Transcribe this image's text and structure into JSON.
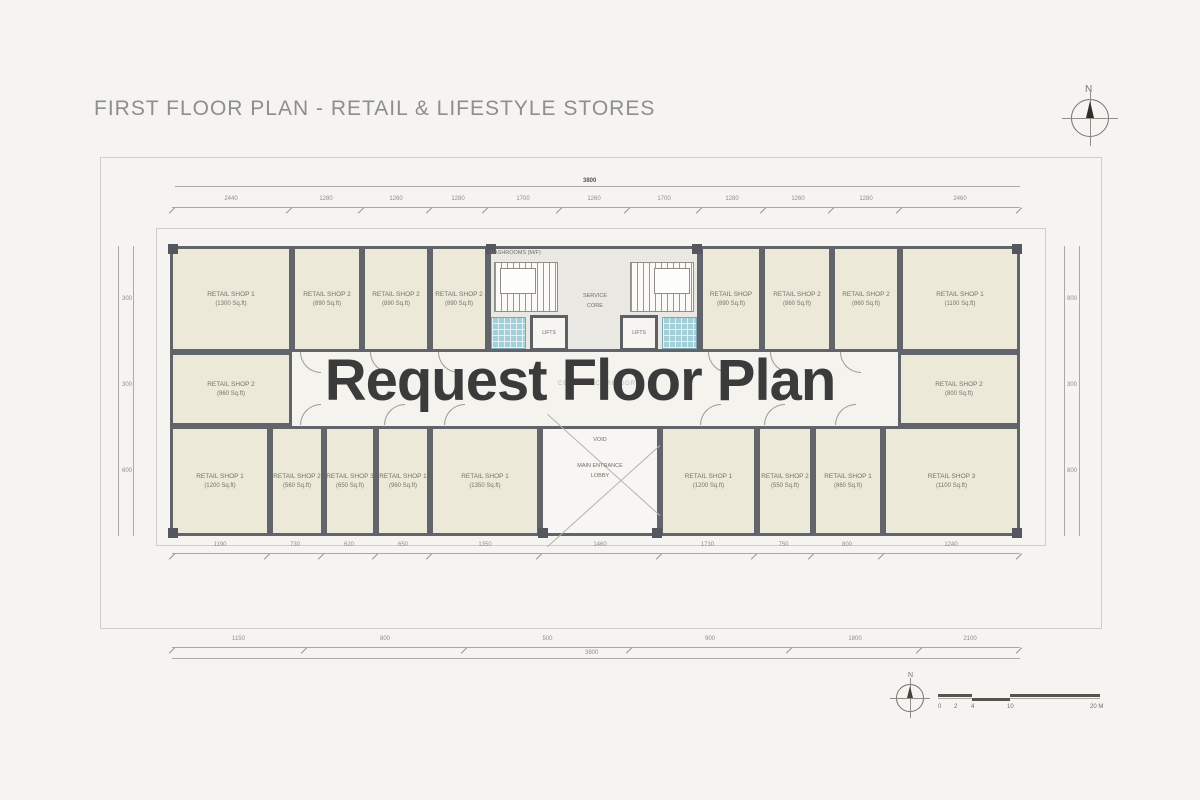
{
  "header": {
    "title": "FIRST FLOOR PLAN - RETAIL & LIFESTYLE STORES"
  },
  "watermark": {
    "text": "Request Floor Plan"
  },
  "compass": {
    "north_label": "N"
  },
  "mini_compass": {
    "north_label": "N"
  },
  "core": {
    "washrooms_label": "WASHROOMS (M/F)",
    "service_line1": "SERVICE",
    "service_line2": "CORE",
    "lifts_left": "LIFTS",
    "lifts_right": "LIFTS",
    "corridor_label": "CENTRAL CORRIDOR",
    "void_label": "VOID",
    "lobby_line1": "MAIN ENTRANCE",
    "lobby_line2": "LOBBY"
  },
  "shops": {
    "top_left": [
      {
        "name": "RETAIL SHOP 1",
        "area": "(1300 Sq.ft)"
      },
      {
        "name": "RETAIL SHOP 2",
        "area": "(890 Sq.ft)"
      },
      {
        "name": "RETAIL SHOP 2",
        "area": "(890 Sq.ft)"
      },
      {
        "name": "RETAIL SHOP 2",
        "area": "(890 Sq.ft)"
      }
    ],
    "top_right": [
      {
        "name": "RETAIL SHOP",
        "area": "(890 Sq.ft)"
      },
      {
        "name": "RETAIL SHOP 2",
        "area": "(860 Sq.ft)"
      },
      {
        "name": "RETAIL SHOP 2",
        "area": "(860 Sq.ft)"
      },
      {
        "name": "RETAIL SHOP 1",
        "area": "(1100 Sq.ft)"
      }
    ],
    "mid_left": {
      "name": "RETAIL SHOP 2",
      "area": "(860 Sq.ft)"
    },
    "mid_right": {
      "name": "RETAIL SHOP 2",
      "area": "(800 Sq.ft)"
    },
    "bottom_left": [
      {
        "name": "RETAIL SHOP 1",
        "area": "(1200 Sq.ft)"
      },
      {
        "name": "RETAIL SHOP 2",
        "area": "(560 Sq.ft)"
      },
      {
        "name": "RETAIL SHOP 3",
        "area": "(650 Sq.ft)"
      },
      {
        "name": "RETAIL SHOP 1",
        "area": "(960 Sq.ft)"
      },
      {
        "name": "RETAIL SHOP 1",
        "area": "(1350 Sq.ft)"
      }
    ],
    "bottom_right": [
      {
        "name": "RETAIL SHOP 1",
        "area": "(1200 Sq.ft)"
      },
      {
        "name": "RETAIL SHOP 2",
        "area": "(550 Sq.ft)"
      },
      {
        "name": "RETAIL SHOP 1",
        "area": "(860 Sq.ft)"
      },
      {
        "name": "RETAIL SHOP 3",
        "area": "(1100 Sq.ft)"
      }
    ]
  },
  "dims": {
    "top_overall": "3800",
    "bottom_overall": "3800",
    "top": [
      "2440",
      "1280",
      "1260",
      "1280",
      "1700",
      "1260",
      "1700",
      "1280",
      "1260",
      "1280",
      "2460"
    ],
    "row1": [
      "1190",
      "730",
      "620",
      "650",
      "1350",
      "1460",
      "1730",
      "750",
      "800",
      "1240"
    ],
    "row2": [
      "1150",
      "800",
      "500",
      "900",
      "1800",
      "2100"
    ],
    "left": [
      "300",
      "300",
      "600"
    ],
    "right": [
      "800",
      "300",
      "800"
    ]
  },
  "scale": {
    "labels": [
      "0",
      "2",
      "4",
      "10",
      "20 M"
    ]
  }
}
